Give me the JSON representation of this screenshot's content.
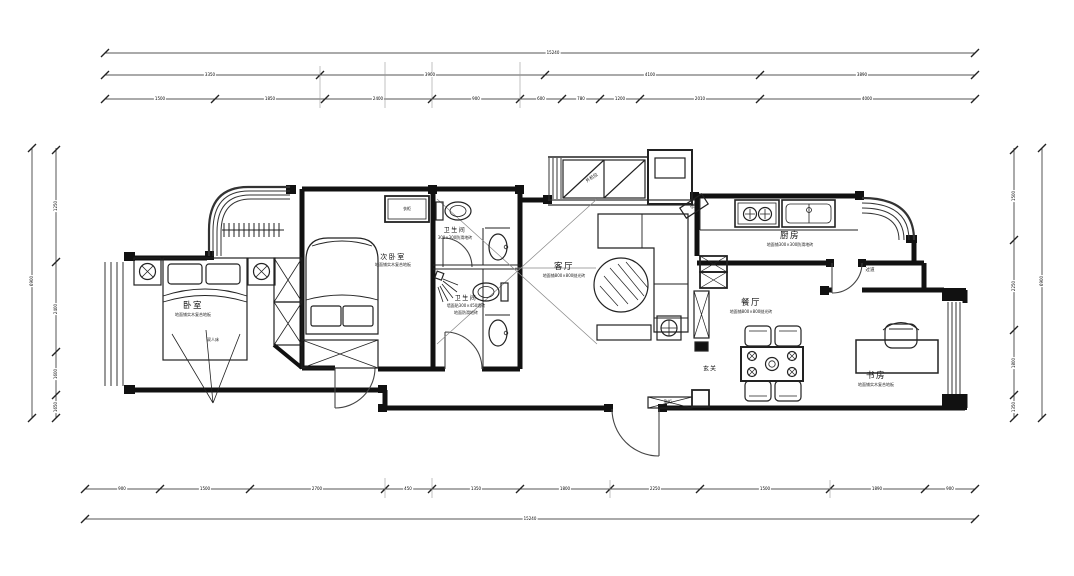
{
  "rooms": {
    "bedroom": {
      "name": "卧室",
      "spec": "地面铺实木复合地板"
    },
    "second_bedroom": {
      "name": "次卧室",
      "spec": "地面铺实木复合地板"
    },
    "living_room": {
      "name": "客厅",
      "spec": "地面铺800×800抛光砖"
    },
    "kitchen": {
      "name": "厨房",
      "spec": "地面铺300×300防滑地砖"
    },
    "dining_room": {
      "name": "餐厅",
      "spec": "地面铺800×800抛光砖"
    },
    "study": {
      "name": "书房",
      "spec": "地面铺实木复合地板"
    },
    "bathroom_top": {
      "name": "卫生间",
      "spec": "300×300防滑地砖"
    },
    "bathroom_bottom": {
      "name": "卫生间",
      "spec": "墙面贴300×450墙砖",
      "spec2": "地面防滑地砖"
    },
    "entry": {
      "name": "玄关"
    },
    "corridor": {
      "name": "过道"
    }
  },
  "furniture_labels": {
    "bed": "双人床",
    "wardrobe": "衣柜",
    "shoe_cabinet": "鞋柜",
    "ac_platform": "外机位",
    "air_conditioner": "空调"
  },
  "dimensions": {
    "top_total": "15240",
    "top_row2": [
      "3350",
      "3900",
      "4100",
      "3890"
    ],
    "top_row3": [
      "1500",
      "1850",
      "2400",
      "900",
      "600",
      "780",
      "1200",
      "2010",
      "4000"
    ],
    "bottom_row": [
      "900",
      "1500",
      "2700",
      "450",
      "1350",
      "1800",
      "2250",
      "1500",
      "1890",
      "900"
    ],
    "bottom_total": "15240",
    "left_total": "6900",
    "left_segments": [
      "1250",
      "2400",
      "1600",
      "1650"
    ],
    "right_total": "6900",
    "right_segments": [
      "1500",
      "2250",
      "1800",
      "1350"
    ]
  },
  "colors": {
    "line": "#1a1a1a",
    "dim_line": "#555555",
    "background": "#ffffff"
  }
}
